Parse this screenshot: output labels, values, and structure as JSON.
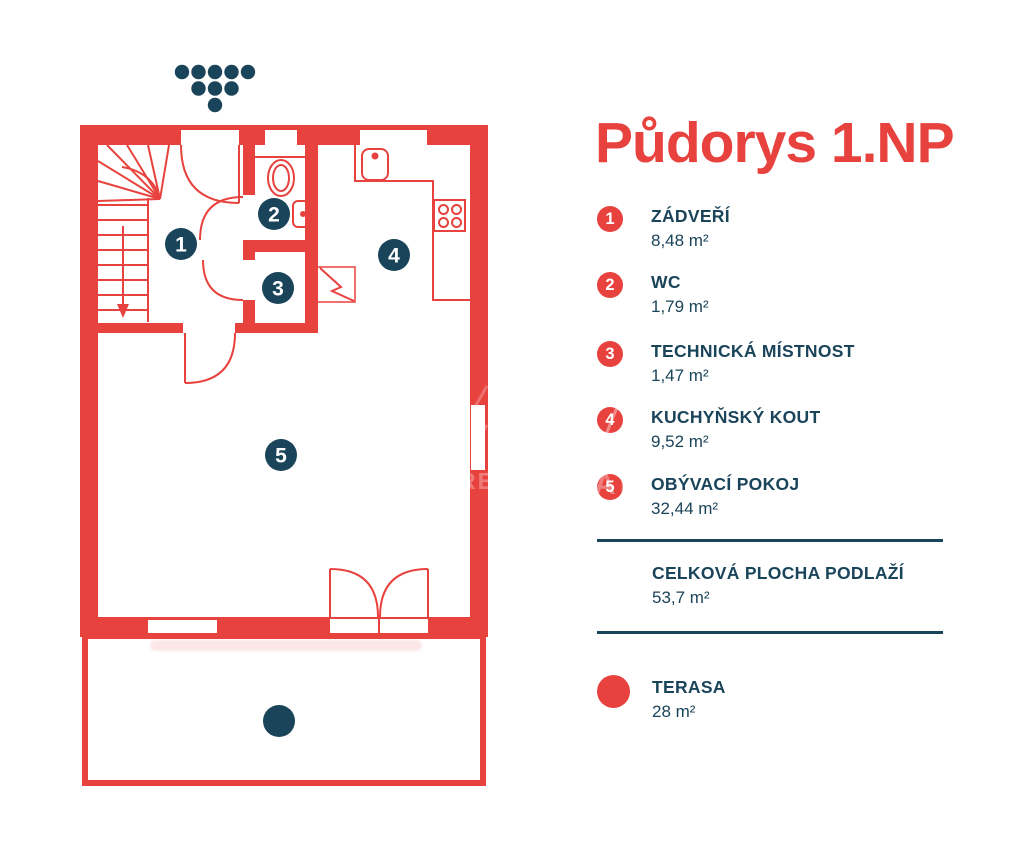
{
  "title": "Půdorys 1.NP",
  "colors": {
    "red": "#E8423E",
    "navy": "#1A4459",
    "white": "#ffffff"
  },
  "legend": {
    "items": [
      {
        "number": "1",
        "name": "ZÁDVEŘÍ",
        "area": "8,48 m²"
      },
      {
        "number": "2",
        "name": "WC",
        "area": "1,79 m²"
      },
      {
        "number": "3",
        "name": "TECHNICKÁ MÍSTNOST",
        "area": "1,47 m²"
      },
      {
        "number": "4",
        "name": "KUCHYŇSKÝ KOUT",
        "area": "9,52 m²"
      },
      {
        "number": "5",
        "name": "OBÝVACÍ POKOJ",
        "area": "32,44 m²"
      }
    ],
    "total": {
      "name": "CELKOVÁ PLOCHA PODLAŽÍ",
      "area": "53,7 m²"
    },
    "terrace": {
      "name": "TERASA",
      "area": "28 m²"
    }
  },
  "watermark": {
    "visible_letters_1": "RE",
    "visible_letters_2": "AK"
  }
}
